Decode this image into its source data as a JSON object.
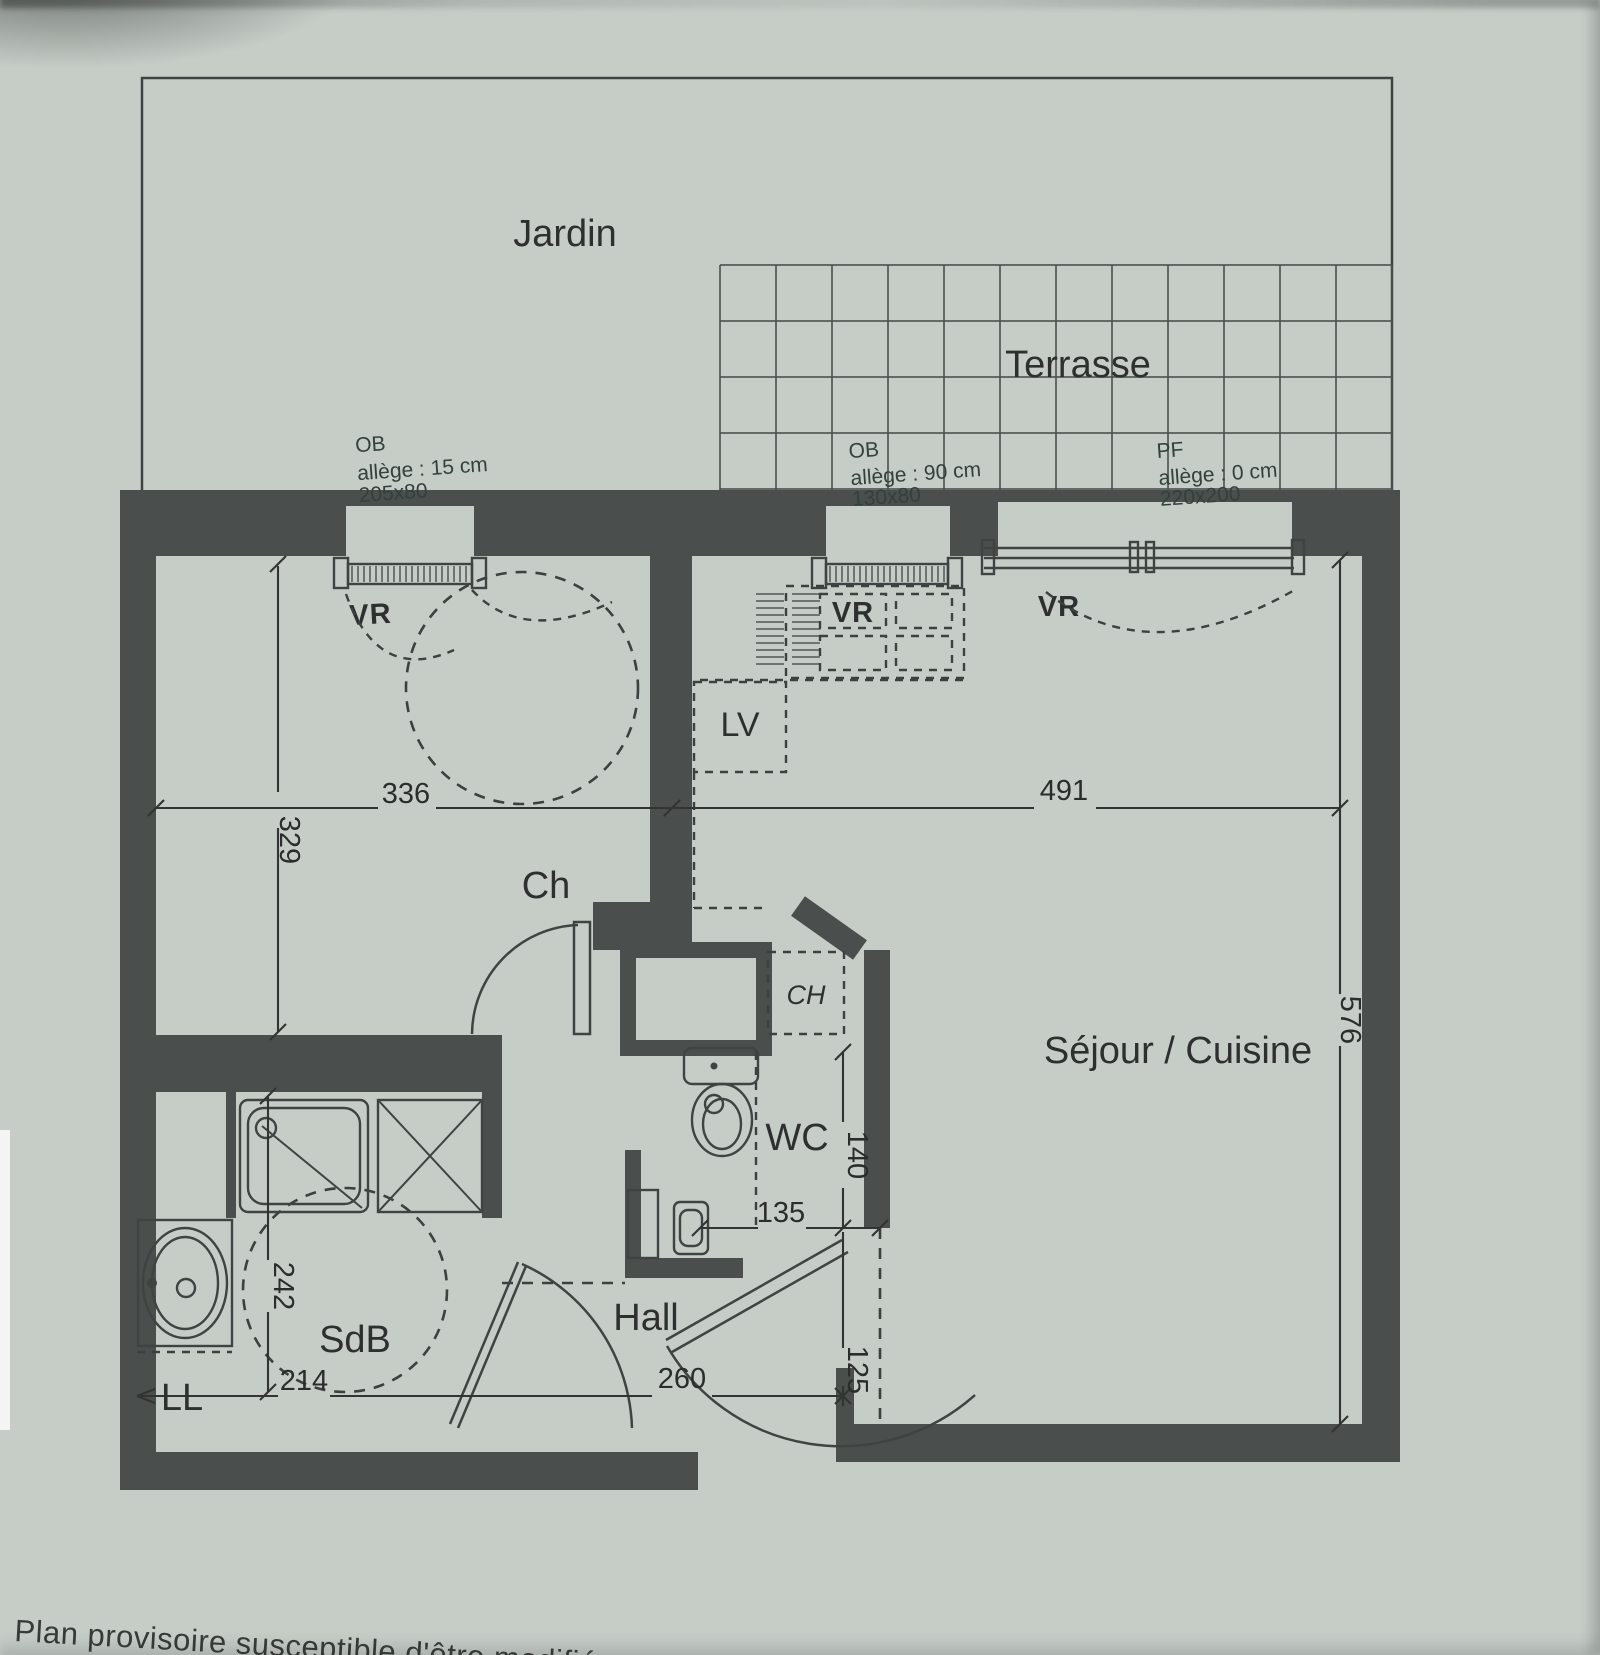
{
  "plan": {
    "outdoor": {
      "jardin": "Jardin",
      "terrasse": "Terrasse"
    },
    "rooms": {
      "ch": "Ch",
      "lv": "LV",
      "sejour_cuisine": "Séjour / Cuisine",
      "wc": "WC",
      "hall": "Hall",
      "sdb": "SdB",
      "ll": "LL",
      "ch_heater": "CH"
    },
    "shutters": {
      "vr_left": "VR",
      "vr_middle": "VR",
      "vr_right": "VR"
    },
    "windows": {
      "left": {
        "type": "OB",
        "allege": "allège : 15 cm",
        "size": "205x80"
      },
      "middle": {
        "type": "OB",
        "allege": "allège : 90 cm",
        "size": "130x80"
      },
      "right": {
        "type": "PF",
        "allege": "allège : 0 cm",
        "size": "220x200"
      }
    },
    "dimensions": {
      "ch_width": "336",
      "ch_depth": "329",
      "sejour_width": "491",
      "sejour_depth": "576",
      "sdb_depth": "242",
      "sdb_width": "214",
      "hall_width": "260",
      "entry_width": "125",
      "wc_width": "135",
      "wc_depth": "140"
    }
  },
  "footer": {
    "caption": "Plan provisoire susceptible d'être modifié"
  },
  "colors": {
    "paper": "#c6cdc7",
    "wall": "#4a4e4c",
    "line": "#3f4341",
    "text": "#2e302f"
  }
}
